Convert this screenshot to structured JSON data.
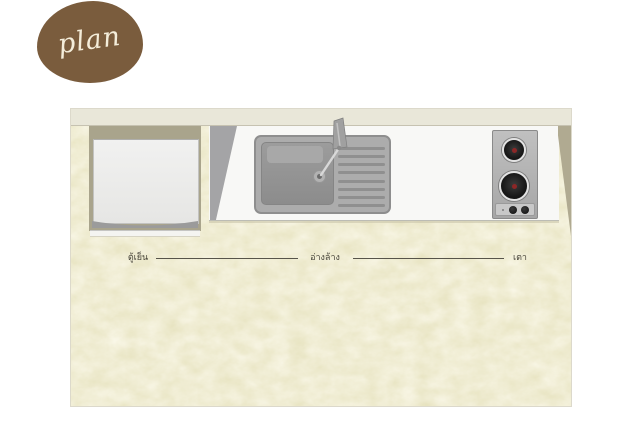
{
  "badge": {
    "label": "plan",
    "color": "#7a5c3d",
    "text_color": "#f4edda"
  },
  "plan": {
    "colors": {
      "floor": "#e7e3c0",
      "wall": "#e9e7d9",
      "counter": "#f8f8f6",
      "shadow_khaki": "#a9a48c",
      "shadow_gray": "#a4a4a6",
      "stainless": "#acacac",
      "burner_red": "#8c2727"
    },
    "fixtures": [
      {
        "id": "refrigerator",
        "icon": "refrigerator-top-icon",
        "label": "ตู้เย็น"
      },
      {
        "id": "sink",
        "icon": "sink-top-icon",
        "label": "อ่างล้าง"
      },
      {
        "id": "stove",
        "icon": "stove-top-icon",
        "label": "เตา"
      }
    ]
  }
}
